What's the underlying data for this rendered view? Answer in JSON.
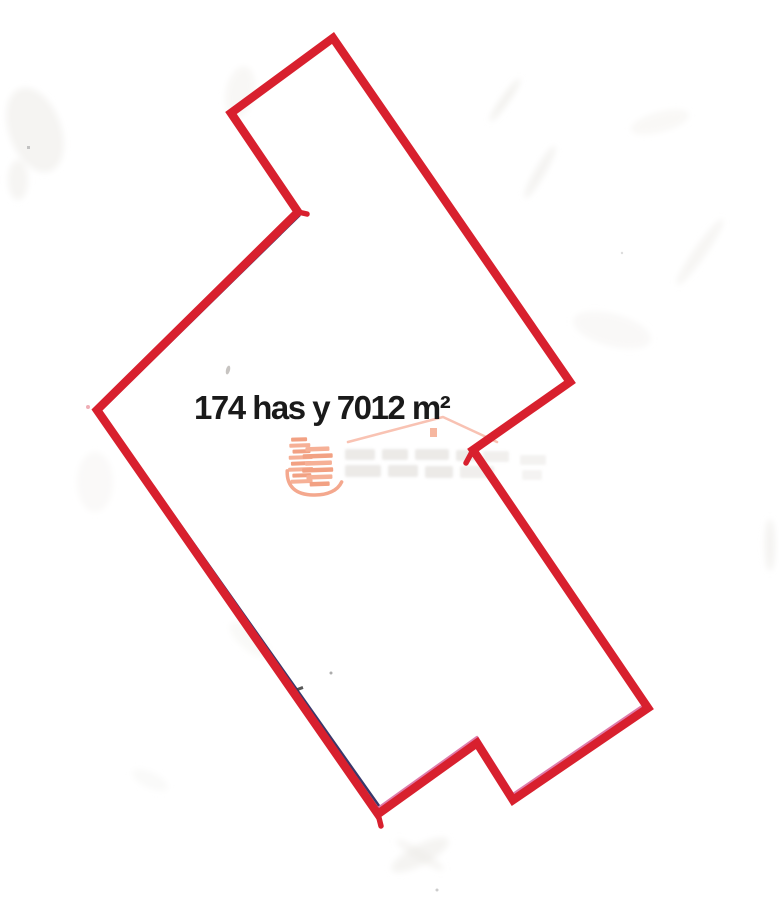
{
  "page": {
    "kind": "scanned parcel sketch",
    "background_color": "#ffffff"
  },
  "parcel": {
    "area_label": "174 has y 7012 m²",
    "outline_color": "#d8202e",
    "outline_width": 8.5,
    "outline_points": "333,38 570,382 473,450 648,708 513,800 477,743 378,814 97,410 298,212 231,113",
    "under_navy_color": "#38386b",
    "under_navy_points": "300,215 100,411 382,810",
    "under_pink_color": "#df7cab",
    "under_pink_points": "648,702 513,794 477,737 378,808",
    "overshoot_stubs": [
      {
        "x1": 473,
        "y1": 450,
        "x2": 466,
        "y2": 463
      },
      {
        "x1": 378,
        "y1": 814,
        "x2": 381,
        "y2": 826
      },
      {
        "x1": 298,
        "y1": 212,
        "x2": 307,
        "y2": 214
      }
    ]
  },
  "watermark": {
    "icon": "buildings-logo-icon",
    "accent_color": "#f2a183",
    "accent_light_color": "#f6b096",
    "roof_color": "#f8bcab",
    "roof_points": "348,442 443,417 497,442",
    "chimney": {
      "x": 430,
      "y": 428,
      "w": 7,
      "h": 9
    },
    "remnant_text_color": "#d9d5d0"
  }
}
